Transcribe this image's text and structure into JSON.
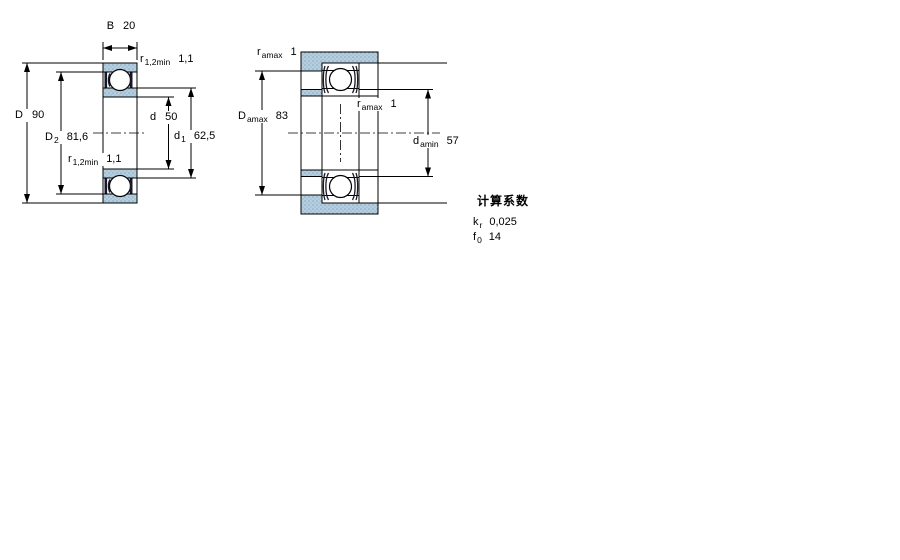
{
  "left_view": {
    "description": "bearing-cross-section-dimensions",
    "labels": {
      "B": {
        "symbol": "B",
        "sub": "",
        "value": "20"
      },
      "r_top": {
        "symbol": "r",
        "sub": "1,2min",
        "value": "1,1"
      },
      "D": {
        "symbol": "D",
        "sub": "",
        "value": "90"
      },
      "D2": {
        "symbol": "D",
        "sub": "2",
        "value": "81,6"
      },
      "d": {
        "symbol": "d",
        "sub": "",
        "value": "50"
      },
      "d1": {
        "symbol": "d",
        "sub": "1",
        "value": "62,5"
      },
      "r_bottom": {
        "symbol": "r",
        "sub": "1,2min",
        "value": "1,1"
      }
    }
  },
  "right_view": {
    "description": "bearing-abutment-fillet-dimensions",
    "labels": {
      "r_amax_top": {
        "symbol": "r",
        "sub": "amax",
        "value": "1"
      },
      "Damax": {
        "symbol": "D",
        "sub": "amax",
        "value": "83"
      },
      "r_amax_mid": {
        "symbol": "r",
        "sub": "amax",
        "value": "1"
      },
      "damin": {
        "symbol": "d",
        "sub": "amin",
        "value": "57"
      }
    }
  },
  "calculation_factors": {
    "heading": "计算系数",
    "rows": [
      {
        "symbol": "k",
        "sub": "r",
        "value": "0,025"
      },
      {
        "symbol": "f",
        "sub": "0",
        "value": "14"
      }
    ]
  },
  "colors": {
    "line": "#000000",
    "hatch_fill": "#b6cfe0",
    "hatch_dot": "#86a8bf",
    "seal_dark": "#181828",
    "background": "#ffffff"
  }
}
